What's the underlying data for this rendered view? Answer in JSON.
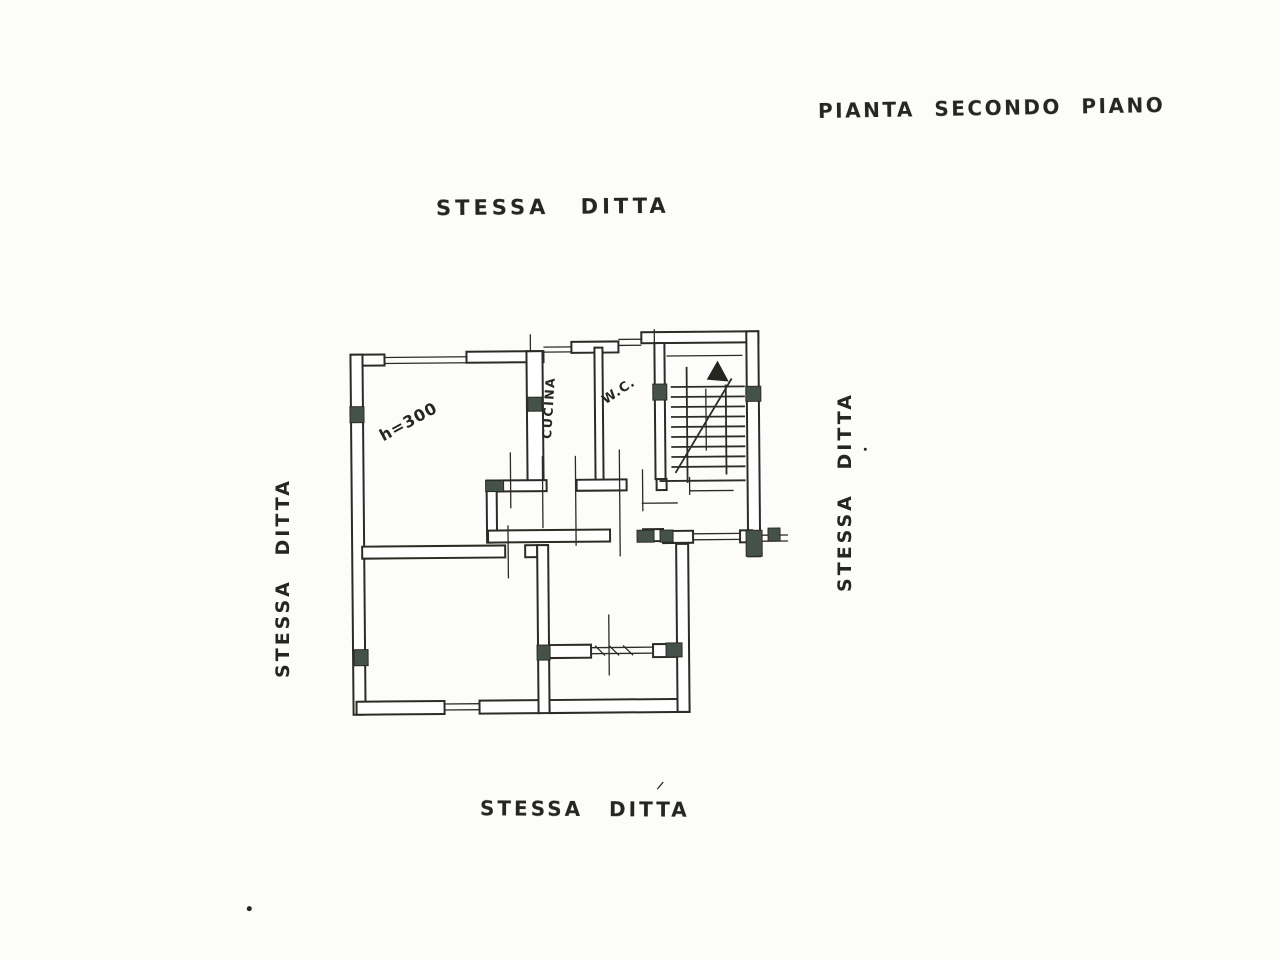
{
  "document": {
    "title": "PIANTA SECONDO PIANO",
    "boundary_labels": {
      "top": "STESSA DITTA",
      "left": "STESSA DITTA",
      "right": "STESSA DITTA",
      "bottom": "STESSA DITTA"
    },
    "room_labels": {
      "height_note": "h=300",
      "kitchen": "CUCINA",
      "wc": "W.C."
    },
    "colors": {
      "ink": "#2c2b26",
      "paper": "#fcfcfa",
      "column_fill": "#44524a"
    }
  }
}
